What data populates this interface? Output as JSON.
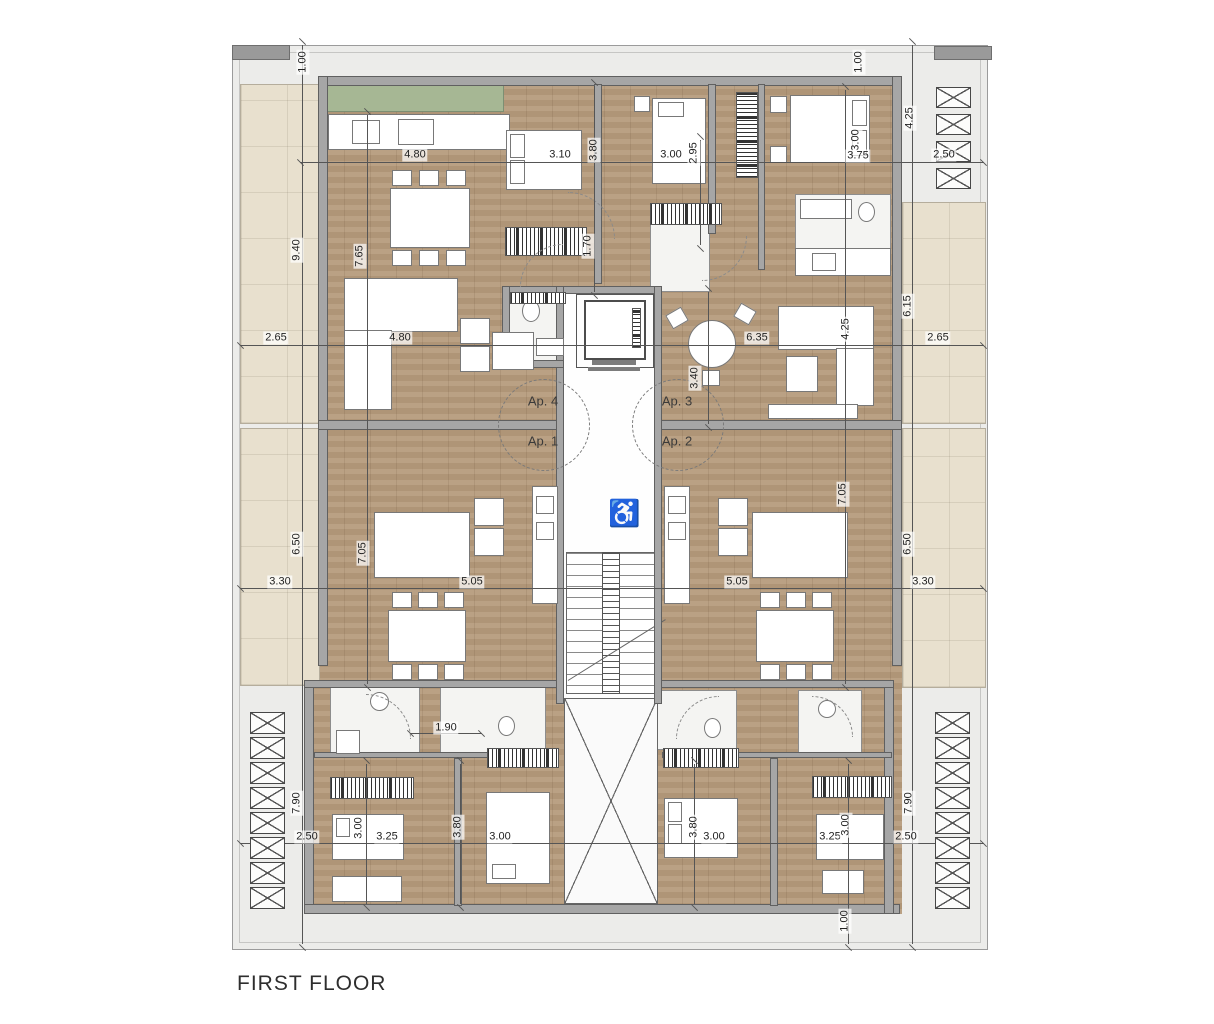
{
  "title": "FIRST FLOOR",
  "plan": {
    "apartment_labels": [
      {
        "text": "Ap. 4",
        "x": 543,
        "y": 401
      },
      {
        "text": "Ap. 3",
        "x": 677,
        "y": 401
      },
      {
        "text": "Ap. 1",
        "x": 543,
        "y": 441
      },
      {
        "text": "Ap. 2",
        "x": 677,
        "y": 441
      }
    ],
    "dimensions": [
      {
        "t": "1.00",
        "x": 303,
        "y": 62,
        "r": 1
      },
      {
        "t": "4.80",
        "x": 415,
        "y": 155,
        "r": 0
      },
      {
        "t": "3.10",
        "x": 560,
        "y": 155,
        "r": 0
      },
      {
        "t": "3.80",
        "x": 594,
        "y": 150,
        "r": 1
      },
      {
        "t": "3.00",
        "x": 671,
        "y": 155,
        "r": 0
      },
      {
        "t": "2.95",
        "x": 694,
        "y": 153,
        "r": 1
      },
      {
        "t": "3.00",
        "x": 856,
        "y": 140,
        "r": 1
      },
      {
        "t": "3.75",
        "x": 858,
        "y": 156,
        "r": 0
      },
      {
        "t": "1.00",
        "x": 859,
        "y": 62,
        "r": 1
      },
      {
        "t": "4.25",
        "x": 910,
        "y": 118,
        "r": 1
      },
      {
        "t": "2.50",
        "x": 944,
        "y": 155,
        "r": 0
      },
      {
        "t": "9.40",
        "x": 297,
        "y": 250,
        "r": 1
      },
      {
        "t": "7.65",
        "x": 360,
        "y": 256,
        "r": 1
      },
      {
        "t": "2.65",
        "x": 276,
        "y": 338,
        "r": 0
      },
      {
        "t": "4.80",
        "x": 400,
        "y": 338,
        "r": 0
      },
      {
        "t": "1.70",
        "x": 588,
        "y": 246,
        "r": 1
      },
      {
        "t": "3.40",
        "x": 695,
        "y": 378,
        "r": 1
      },
      {
        "t": "6.35",
        "x": 757,
        "y": 338,
        "r": 0
      },
      {
        "t": "4.25",
        "x": 846,
        "y": 329,
        "r": 1
      },
      {
        "t": "6.15",
        "x": 908,
        "y": 306,
        "r": 1
      },
      {
        "t": "2.65",
        "x": 938,
        "y": 338,
        "r": 0
      },
      {
        "t": "6.50",
        "x": 297,
        "y": 544,
        "r": 1
      },
      {
        "t": "7.05",
        "x": 363,
        "y": 553,
        "r": 1
      },
      {
        "t": "3.30",
        "x": 280,
        "y": 582,
        "r": 0
      },
      {
        "t": "5.05",
        "x": 472,
        "y": 582,
        "r": 0
      },
      {
        "t": "5.05",
        "x": 737,
        "y": 582,
        "r": 0
      },
      {
        "t": "7.05",
        "x": 843,
        "y": 494,
        "r": 1
      },
      {
        "t": "6.50",
        "x": 908,
        "y": 544,
        "r": 1
      },
      {
        "t": "3.30",
        "x": 923,
        "y": 582,
        "r": 0
      },
      {
        "t": "1.90",
        "x": 446,
        "y": 728,
        "r": 0
      },
      {
        "t": "7.90",
        "x": 297,
        "y": 803,
        "r": 1
      },
      {
        "t": "2.50",
        "x": 307,
        "y": 837,
        "r": 0
      },
      {
        "t": "3.00",
        "x": 359,
        "y": 828,
        "r": 1
      },
      {
        "t": "3.25",
        "x": 387,
        "y": 837,
        "r": 0
      },
      {
        "t": "3.80",
        "x": 458,
        "y": 827,
        "r": 1
      },
      {
        "t": "3.00",
        "x": 500,
        "y": 837,
        "r": 0
      },
      {
        "t": "3.80",
        "x": 694,
        "y": 827,
        "r": 1
      },
      {
        "t": "3.00",
        "x": 714,
        "y": 837,
        "r": 0
      },
      {
        "t": "3.25",
        "x": 830,
        "y": 837,
        "r": 0
      },
      {
        "t": "3.00",
        "x": 846,
        "y": 825,
        "r": 1
      },
      {
        "t": "2.50",
        "x": 906,
        "y": 837,
        "r": 0
      },
      {
        "t": "7.90",
        "x": 909,
        "y": 803,
        "r": 1
      },
      {
        "t": "1.00",
        "x": 845,
        "y": 921,
        "r": 1
      }
    ],
    "louvers": [
      {
        "x": 936,
        "y": 87,
        "w": 33,
        "h": 19,
        "count": 4,
        "gap": 27
      },
      {
        "x": 250,
        "y": 712,
        "w": 33,
        "h": 20,
        "count": 8,
        "gap": 25
      },
      {
        "x": 935,
        "y": 712,
        "w": 33,
        "h": 20,
        "count": 8,
        "gap": 25
      }
    ],
    "icons": {
      "wheelchair": "♿"
    },
    "colors": {
      "wood": "#b59a7b",
      "terrace": "#e8e0ce",
      "wall": "#a6a6a6",
      "planter": "#a6b794",
      "walkway": "#ececea",
      "bath": "#f4f4f2",
      "dimension_line": "#555555",
      "text": "#2e2e2e"
    }
  }
}
